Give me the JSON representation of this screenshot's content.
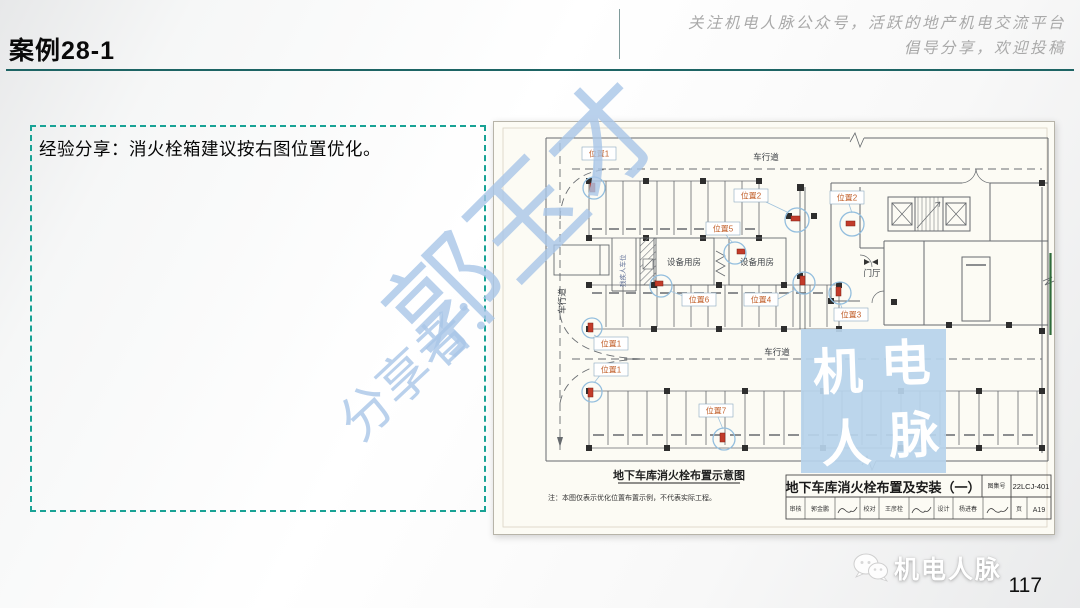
{
  "slide": {
    "title": "案例28-1",
    "page_number": "117"
  },
  "header": {
    "tagline_line1": "关注机电人脉公众号，活跃的地产机电交流平台",
    "tagline_line2": "倡导分享，欢迎投稿"
  },
  "note_box": {
    "text": "经验分享：消火栓箱建议按右图位置优化。"
  },
  "watermark": {
    "prefix": "分享者：",
    "name": "郭玉才"
  },
  "footer": {
    "brand": "机电人脉"
  },
  "drawing": {
    "caption": "地下车库消火栓布置示意图",
    "footnote": "注：本图仅表示优化位置布置示例，不代表实际工程。",
    "lanes": {
      "top": "车行道",
      "left": "车行道",
      "middle": "车行道"
    },
    "rooms": {
      "equipment1": "设备用房",
      "equipment2": "设备用房",
      "lobby": "门厅",
      "accessible": "残疾人车位"
    },
    "positions": {
      "p1a": "位置1",
      "p1b": "位置1",
      "p1c": "位置1",
      "p2a": "位置2",
      "p2b": "位置2",
      "p3": "位置3",
      "p4": "位置4",
      "p5": "位置5",
      "p6": "位置6",
      "p7": "位置7"
    },
    "stamp": {
      "c1": "机",
      "c2": "电",
      "c3": "人",
      "c4": "脉"
    },
    "title_block": {
      "title": "地下车库消火栓布置及安装（一）",
      "atlas_label": "图集号",
      "atlas_no": "22LCJ-401",
      "review_label": "审核",
      "reviewer": "郭金鹏",
      "check_label": "校对",
      "checker": "王彦栓",
      "design_label": "设计",
      "designer": "杨进春",
      "page_label": "页",
      "page_no": "A19"
    }
  }
}
